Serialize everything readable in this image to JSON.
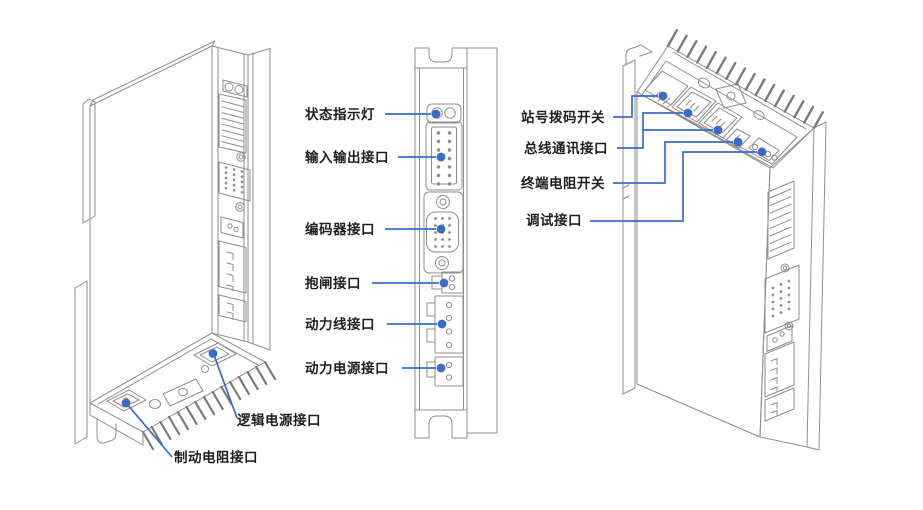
{
  "diagram": {
    "description_colors": {
      "leader_blue": "#3a6bc8",
      "line_gray": "#8e8e8e",
      "label_text": "#1d1d1d",
      "background": "#ffffff"
    }
  },
  "labels": {
    "front_panel": [
      {
        "id": "status-indicator",
        "text": "状态指示灯"
      },
      {
        "id": "io-port",
        "text": "输入输出接口"
      },
      {
        "id": "encoder-port",
        "text": "编码器接口"
      },
      {
        "id": "brake-port",
        "text": "抱闸接口"
      },
      {
        "id": "power-line-port",
        "text": "动力线接口"
      },
      {
        "id": "power-supply-port",
        "text": "动力电源接口"
      }
    ],
    "bottom_panel": [
      {
        "id": "logic-power-port",
        "text": "逻辑电源接口"
      },
      {
        "id": "brake-resistor-port",
        "text": "制动电阻接口"
      }
    ],
    "top_panel": [
      {
        "id": "station-dip-switch",
        "text": "站号拨码开关"
      },
      {
        "id": "bus-comm-port",
        "text": "总线通讯接口"
      },
      {
        "id": "terminal-resistor-switch",
        "text": "终端电阻开关"
      },
      {
        "id": "debug-port",
        "text": "调试接口"
      }
    ]
  }
}
